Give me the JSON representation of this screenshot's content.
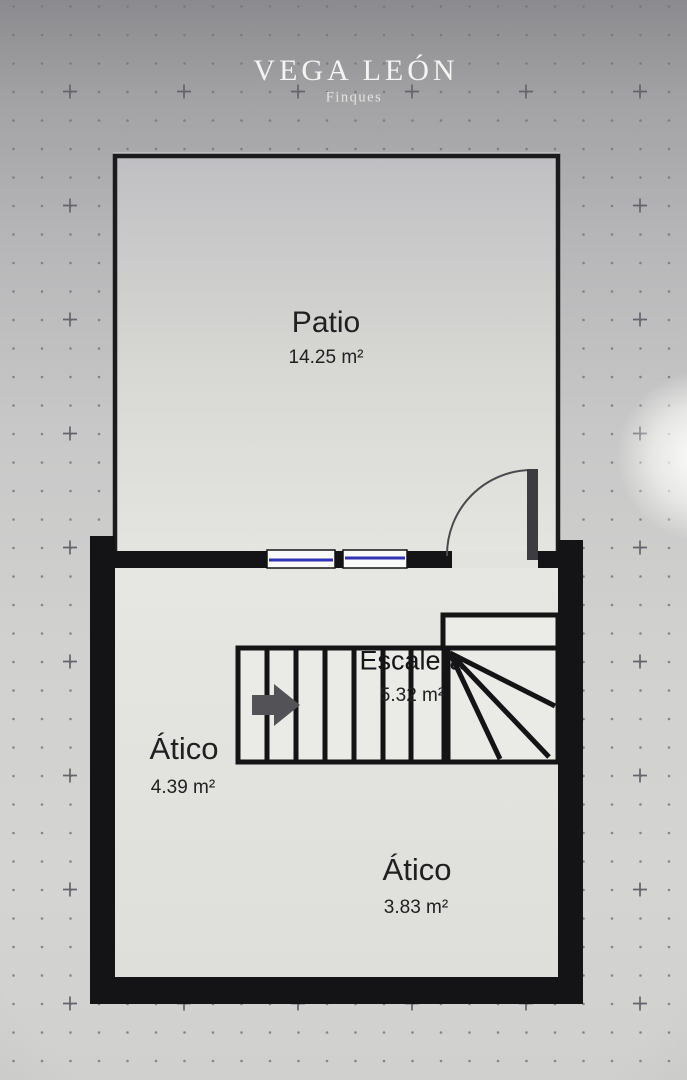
{
  "header": {
    "brand": "VEGA LEÓN",
    "subtitle": "Finques"
  },
  "rooms": [
    {
      "name": "Patio",
      "area": "14.25 m²"
    },
    {
      "name": "Ático",
      "area": "4.39 m²"
    },
    {
      "name": "Escalera",
      "area": "5.32 m²"
    },
    {
      "name": "Ático",
      "area": "3.83 m²"
    }
  ],
  "icons": {
    "stairs_direction_arrow": "right-arrow",
    "door_swing": "quarter-arc"
  },
  "colors": {
    "wall": "#141416",
    "floor": "#e4e4e0",
    "patio_floor_top": "#bfbfc3",
    "window_accent": "#3232b6",
    "door_leaf": "#3d3d41",
    "stairs_arrow": "#535357",
    "label_text": "#202022",
    "brand_text": "#f4f4f2",
    "background_top": "#8b8b8f",
    "background_bottom": "#d0d0ce"
  }
}
